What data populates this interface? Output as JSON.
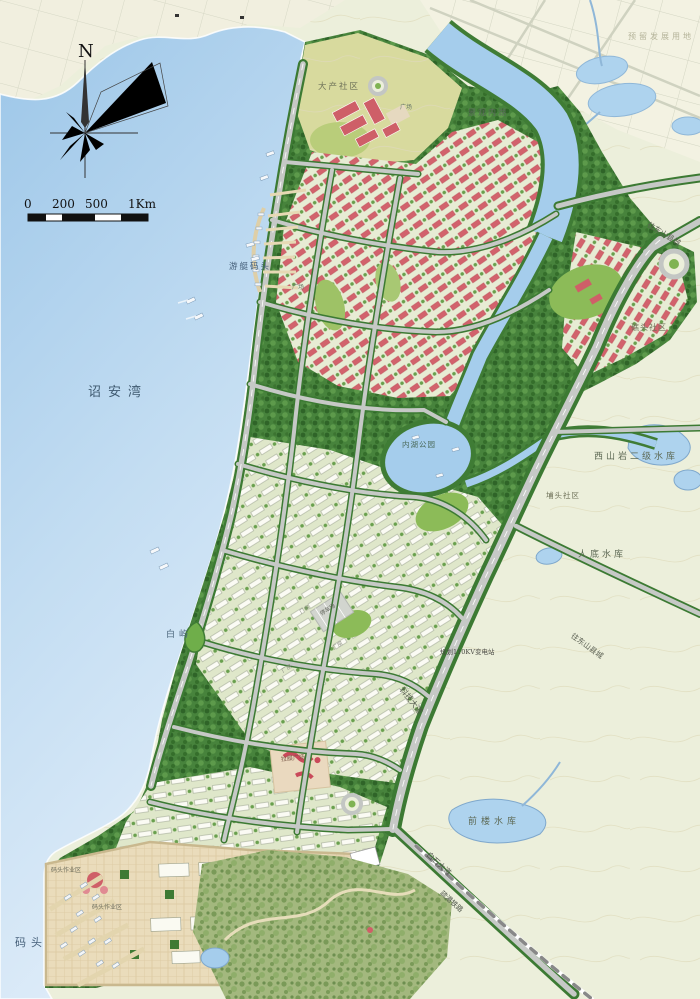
{
  "map": {
    "compass_north": "N",
    "scale_bar": {
      "tick0": "0",
      "tick200": "200",
      "tick500": "500",
      "tick1km": "1Km"
    },
    "labels": {
      "reserved_land": "预留发展用地",
      "dachan_community": "大产社区",
      "landscape_inner_lake": "景观内湖",
      "plaza": "广场",
      "to_dongshan_county": "往东山县城",
      "yacht_marina": "游艇码头",
      "jiaotou_community": "礁头社区",
      "zhaoan_bay": "诏安湾",
      "inner_lake_park": "内湖公园",
      "xishanyan_reservoir": "西山岩二级水库",
      "putou_community": "埔头社区",
      "rendi_reservoir": "人底水库",
      "baiyu_islet": "白屿",
      "planned_substation": "规划110KV变电站",
      "keji_avenue": "科技大道",
      "parking_lot": "停车场",
      "membrane_plaza": "拉膜广场",
      "qianlou_reservoir": "前楼水库",
      "baishi_avenue": "白石大道",
      "port_railway": "疏港铁路",
      "dock_operation_area": "码头作业区",
      "dock": "码头",
      "factory_building": "厂房"
    },
    "colors": {
      "water": "#a9cfec",
      "land": "#ecefdb",
      "greenbelt": "#47833c",
      "residential_roof": "#d2626c",
      "industrial_roof": "#fbfbf4",
      "road": "#c6c9c6",
      "dock_paving": "#eadcbb"
    }
  }
}
